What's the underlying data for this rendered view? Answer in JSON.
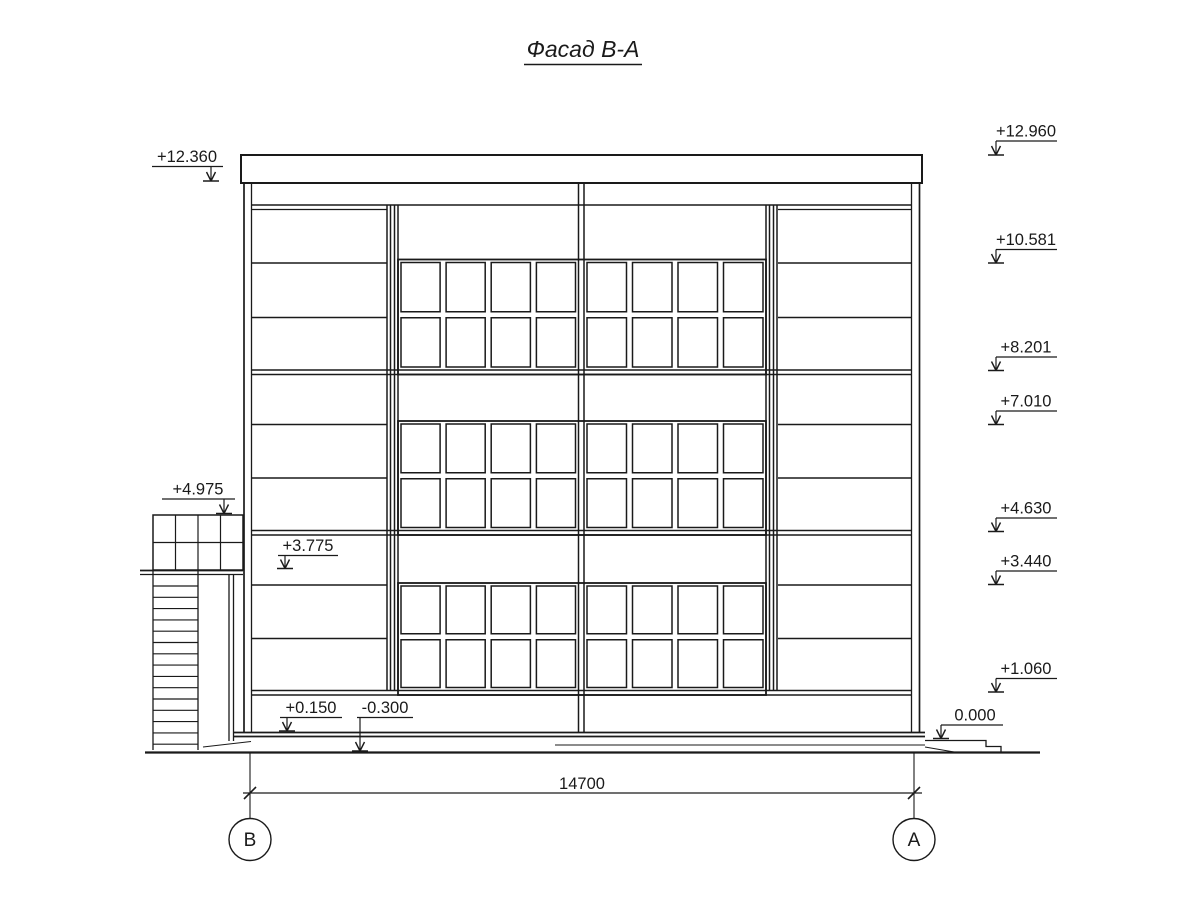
{
  "title": "Фасад В-А",
  "elevations": {
    "left": [
      "+12.360",
      "+4.975",
      "+3.775",
      "+0.150",
      "-0.300"
    ],
    "right": [
      "+12.960",
      "+10.581",
      "+8.201",
      "+7.010",
      "+4.630",
      "+3.440",
      "+1.060",
      "0.000"
    ]
  },
  "dimension": {
    "value": "14700"
  },
  "axes": {
    "left": "В",
    "right": "А"
  },
  "colors": {
    "line": "#1a1a1a",
    "background": "#ffffff"
  }
}
